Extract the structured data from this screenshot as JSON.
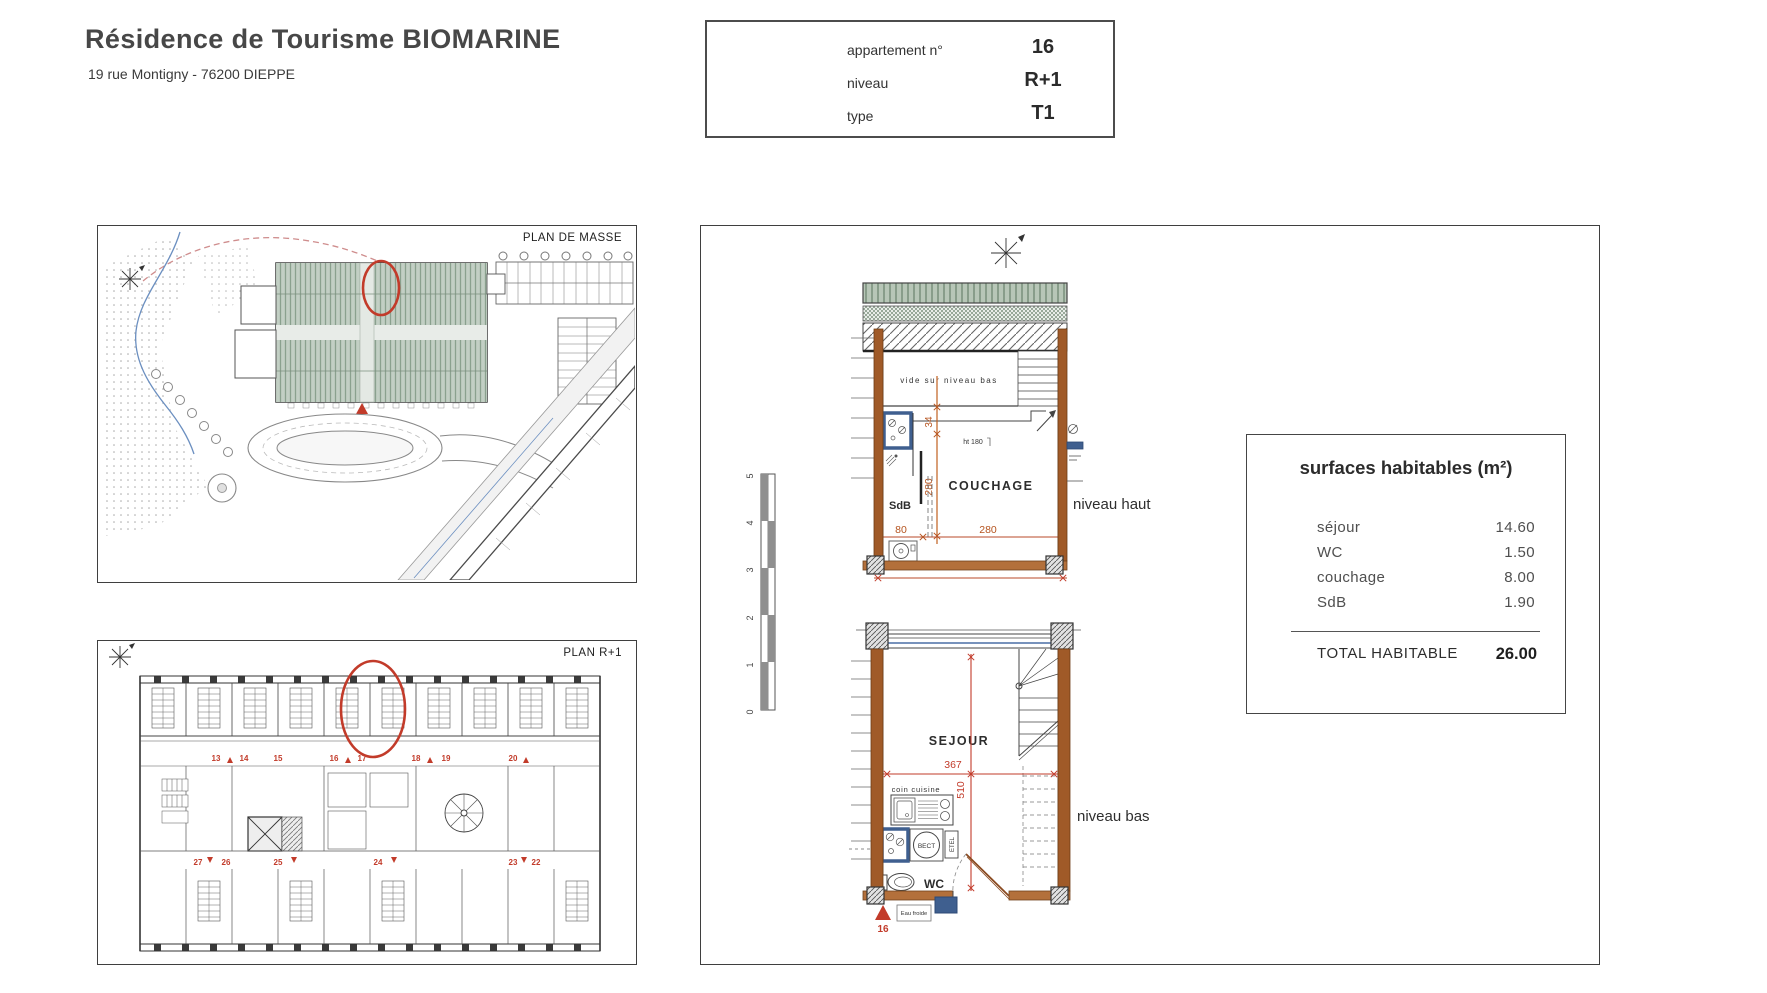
{
  "document": {
    "title": "Résidence de Tourisme BIOMARINE",
    "address": "19 rue Montigny - 76200 DIEPPE"
  },
  "info_box": {
    "rows": [
      {
        "label": "appartement n°",
        "value": "16"
      },
      {
        "label": "niveau",
        "value": "R+1"
      },
      {
        "label": "type",
        "value": "T1"
      }
    ]
  },
  "plan_masse": {
    "title": "PLAN DE MASSE"
  },
  "plan_r1": {
    "title": "PLAN R+1",
    "unit_numbers_top": [
      "13",
      "14",
      "15",
      "16",
      "17",
      "18",
      "19",
      "20"
    ],
    "unit_numbers_bottom": [
      "27",
      "26",
      "25",
      "24",
      "23",
      "22"
    ]
  },
  "detail_plans": {
    "upper": {
      "level_label": "niveau haut",
      "room_couchage": "COUCHAGE",
      "room_sdb": "SdB",
      "note_vide": "vide sur niveau bas",
      "note_height": "ht 180",
      "dim_34": "34",
      "dim_280_vertical": "280",
      "dim_80": "80",
      "dim_280_horizontal": "280"
    },
    "lower": {
      "level_label": "niveau bas",
      "room_sejour": "SEJOUR",
      "room_wc": "WC",
      "note_coin_cuisine": "coin cuisine",
      "equip_bect": "BECT",
      "equip_etel": "ETEL",
      "note_eau_froide": "Eau froide",
      "dim_367": "367",
      "dim_510": "510",
      "apartment_marker": "16"
    },
    "scale_ticks": [
      "5",
      "4",
      "3",
      "2",
      "1",
      "0"
    ]
  },
  "surfaces": {
    "title": "surfaces habitables (m²)",
    "rows": [
      {
        "label": "séjour",
        "value": "14.60"
      },
      {
        "label": "WC",
        "value": "1.50"
      },
      {
        "label": "couchage",
        "value": "8.00"
      },
      {
        "label": "SdB",
        "value": "1.90"
      }
    ],
    "total_label": "TOTAL HABITABLE",
    "total_value": "26.00"
  },
  "colors": {
    "annotation_red": "#c23b2a",
    "dimension_orange": "#b5531e",
    "wood_brown": "#a05a28",
    "fixture_blue": "#3f5f8f",
    "roof_green": "#b7c6b7"
  }
}
